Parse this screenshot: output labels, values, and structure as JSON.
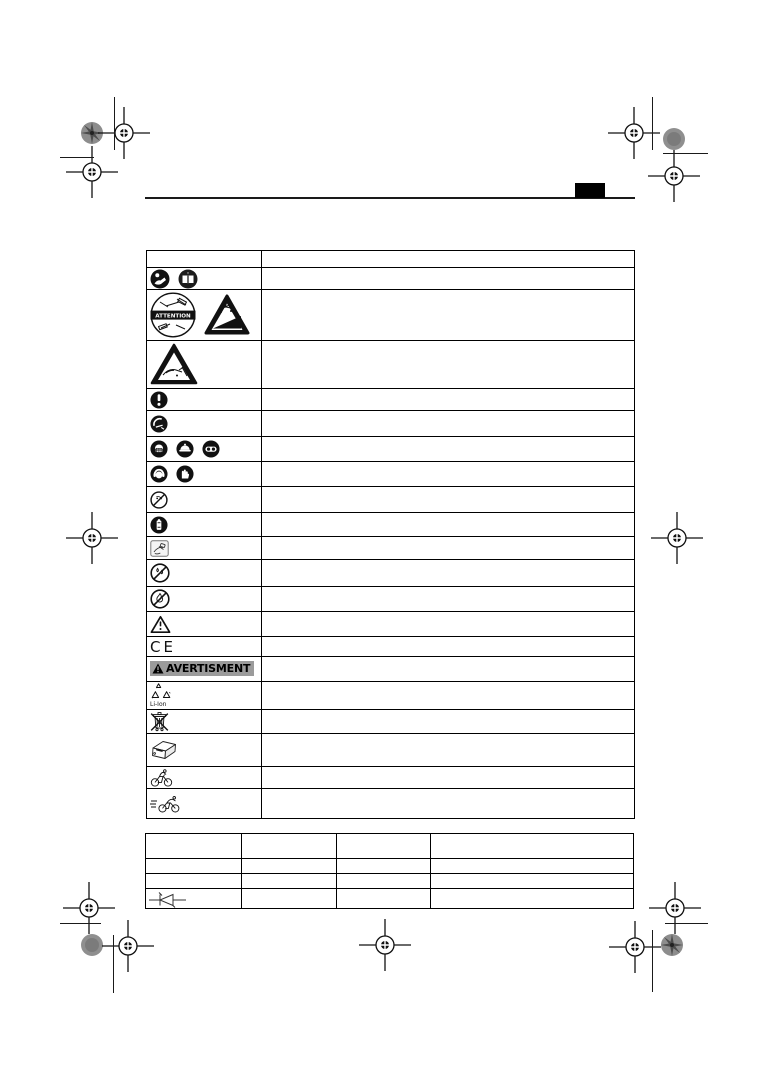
{
  "page": {
    "kind": "instruction-manual symbol legend page",
    "header_tab_label": "",
    "ink_color": "#111111",
    "badge_bg_color": "#9b9b9b"
  },
  "attention_icon_text": "ATTENTION",
  "warning_badge": {
    "text": "AVERTISMENT"
  },
  "ce_mark": {
    "text": "CE"
  },
  "li_ion": {
    "label": "Li-Ion"
  },
  "icons": {
    "read-manual-icon": "black circle, person reading manual (white)",
    "instruction-book-icon": "black circle, open book with i",
    "attention-circle-icon": "circle with ATTENTION banner and tool sketches",
    "thrown-objects-warning-icon": "black triangle, debris thrown from ramp",
    "cut-hand-warning-icon": "black triangle outline, hand cut by blade",
    "exclamation-circle-icon": "black circle with white !",
    "rotating-blade-circle-icon": "black circle with blade/hand detail",
    "dust-mask-icon": "black circle, face with dust mask",
    "safety-helmet-icon": "black circle, helmet",
    "eye-protection-icon": "black circle, goggles",
    "ear-protection-icon": "black circle, ear muffs",
    "protective-gloves-icon": "black circle, glove",
    "no-touch-prohibition-icon": "crossed-out circle over object",
    "remove-battery-icon": "black circle with white battery",
    "insert-battery-hand-icon": "square with hand holding battery",
    "no-water-prohibition-icon": "crossed-out circle over water drops",
    "no-fire-prohibition-icon": "crossed-out circle over flame",
    "general-warning-icon": "outline warning triangle",
    "warning-triangle-icon": "small filled warning triangle with !",
    "li-ion-recycle-icon": "recycling triangles with Li-Ion label",
    "weee-bin-icon": "crossed-out wheelie bin",
    "charger-icon": "battery charger sketch",
    "bicycle-icon": "person riding bicycle",
    "speed-bicycle-icon": "speeding bicycle with motion lines",
    "diode-icon": "diode circuit symbol",
    "registration-mark-icon": "printer crosshair registration mark",
    "color-patch-icon": "printer colour control dot"
  },
  "symbols_table": {
    "rows": [
      {
        "icons": [],
        "description": ""
      },
      {
        "icons": [
          "read-manual-icon",
          "instruction-book-icon"
        ],
        "description": ""
      },
      {
        "icons": [
          "attention-circle-icon",
          "thrown-objects-warning-icon"
        ],
        "description": ""
      },
      {
        "icons": [
          "cut-hand-warning-icon"
        ],
        "description": ""
      },
      {
        "icons": [
          "exclamation-circle-icon"
        ],
        "description": ""
      },
      {
        "icons": [
          "rotating-blade-circle-icon"
        ],
        "description": ""
      },
      {
        "icons": [
          "dust-mask-icon",
          "safety-helmet-icon",
          "eye-protection-icon"
        ],
        "description": ""
      },
      {
        "icons": [
          "ear-protection-icon",
          "protective-gloves-icon"
        ],
        "description": ""
      },
      {
        "icons": [
          "no-touch-prohibition-icon"
        ],
        "description": ""
      },
      {
        "icons": [
          "remove-battery-icon"
        ],
        "description": ""
      },
      {
        "icons": [
          "insert-battery-hand-icon"
        ],
        "description": ""
      },
      {
        "icons": [
          "no-water-prohibition-icon"
        ],
        "description": ""
      },
      {
        "icons": [
          "no-fire-prohibition-icon"
        ],
        "description": ""
      },
      {
        "icons": [
          "general-warning-icon"
        ],
        "description": ""
      },
      {
        "icons": [
          "ce-mark"
        ],
        "description": ""
      },
      {
        "icons": [
          "warning-badge"
        ],
        "description": ""
      },
      {
        "icons": [
          "li-ion-recycle-icon"
        ],
        "description": ""
      },
      {
        "icons": [
          "weee-bin-icon"
        ],
        "description": ""
      },
      {
        "icons": [
          "charger-icon"
        ],
        "description": ""
      },
      {
        "icons": [
          "bicycle-icon"
        ],
        "description": ""
      },
      {
        "icons": [
          "speed-bicycle-icon"
        ],
        "description": ""
      }
    ]
  },
  "spec_table": {
    "headers": [
      "",
      "",
      "",
      ""
    ],
    "rows": [
      [
        "",
        "",
        "",
        ""
      ],
      [
        "",
        "",
        "",
        ""
      ],
      [
        "diode-icon",
        "",
        "",
        ""
      ]
    ]
  }
}
